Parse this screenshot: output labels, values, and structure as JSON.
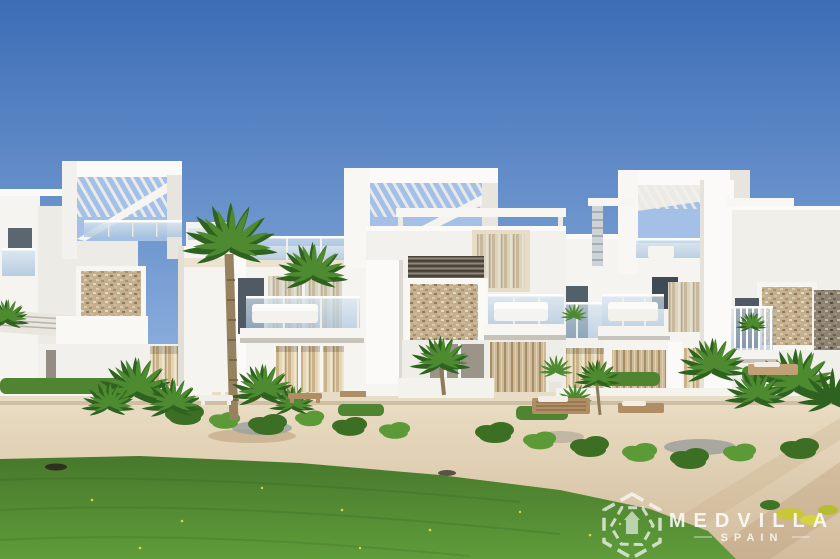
{
  "watermark": {
    "brand": "MEDVILLA",
    "region": "SPAIN",
    "icon": "hexagon-house-logo-icon"
  },
  "colors": {
    "sky_top": "#3c6db6",
    "sky_horizon": "#96b7e1",
    "sky_lite": "#a4c0e6",
    "wall_white": "#f5f4f1",
    "wall_bright": "#fbfaf8",
    "wall_shade": "#e8e5df",
    "stone_beige": "#c3ae8e",
    "stone_dark": "#8d8272",
    "glass_hi": "#d6e4f0",
    "glass_lo": "#a8c3dc",
    "curtain_beige": "#e3d4b4",
    "wood": "#b08d62",
    "palm_green": "#4e8a2f",
    "palm_green_dark": "#2f6220",
    "shrub_green": "#3c6f23",
    "shrub_green_light": "#5c9a38",
    "lawn_dark": "#47782c",
    "lawn_light": "#5f9c3a",
    "sand_light": "#e9dcc2",
    "sand_dark": "#d2bc9d",
    "trunk_brown": "#97825f",
    "logo_white": "#ffffff"
  }
}
